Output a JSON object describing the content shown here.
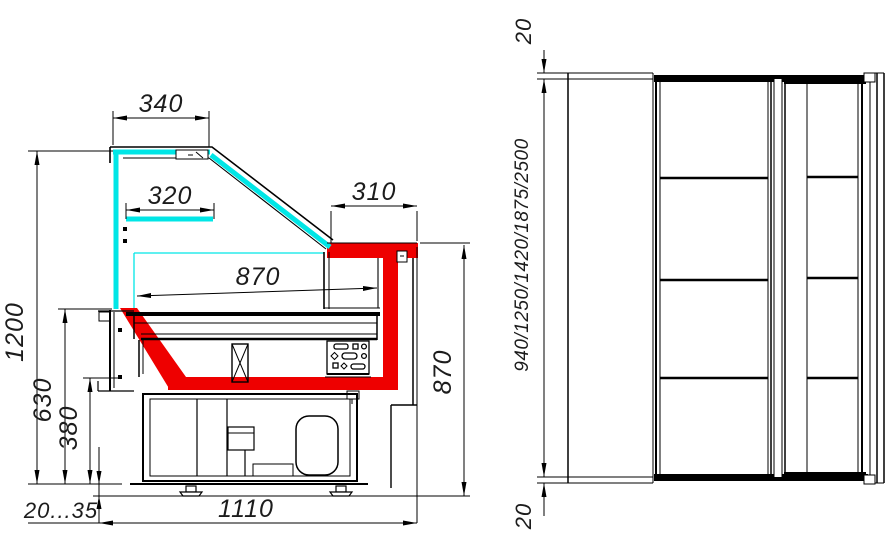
{
  "drawing": {
    "type": "technical-drawing-refrigerated-display-case",
    "colors": {
      "outline": "#000000",
      "glass_highlight": "#00E6E6",
      "insulation_highlight": "#EE0000",
      "background": "#FFFFFF"
    },
    "side_view": {
      "dimensions": {
        "canopy_width": "340",
        "shelf_depth": "320",
        "counter_depth": "310",
        "well_depth": "870",
        "overall_height": "1200",
        "front_panel_height": "630",
        "base_height": "380",
        "leg_adjustment": "20...35",
        "base_depth": "1110",
        "rear_height": "870"
      }
    },
    "end_view": {
      "dimensions": {
        "end_overhang_top": "20",
        "case_length_options": "940/1250/1420/1875/2500",
        "end_overhang_bottom": "20"
      }
    }
  }
}
